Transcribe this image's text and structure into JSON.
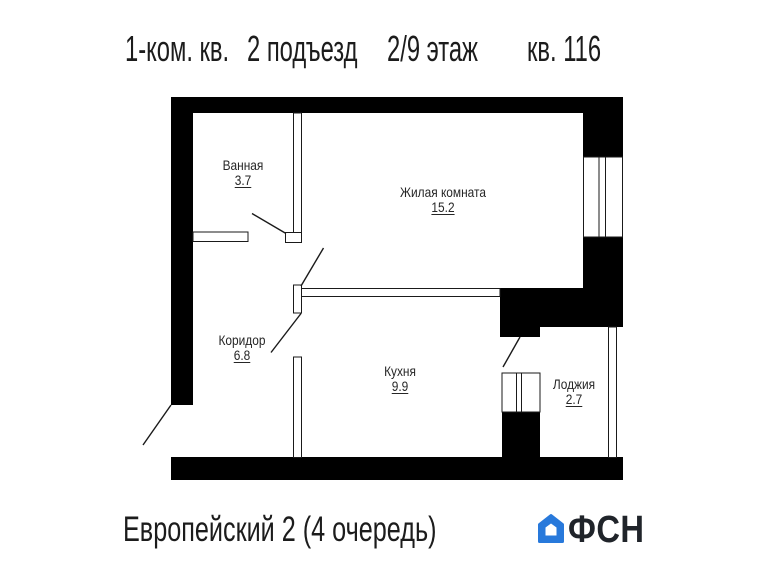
{
  "header": {
    "segments": [
      "1-ком. кв.",
      "2 подъезд",
      "2/9 этаж",
      "кв. 116"
    ]
  },
  "rooms": [
    {
      "name": "Ванная",
      "area": "3.7"
    },
    {
      "name": "Жилая комната",
      "area": "15.2"
    },
    {
      "name": "Коридор",
      "area": "6.8"
    },
    {
      "name": "Кухня",
      "area": "9.9"
    },
    {
      "name": "Лоджия",
      "area": "2.7"
    }
  ],
  "footer": {
    "project": "Европейский 2 (4 очередь)",
    "logo_text": "ФСН",
    "logo_color": "#2879DB"
  },
  "colors": {
    "walls": "#000000",
    "lines": "#1a1a1a",
    "background": "#ffffff"
  }
}
